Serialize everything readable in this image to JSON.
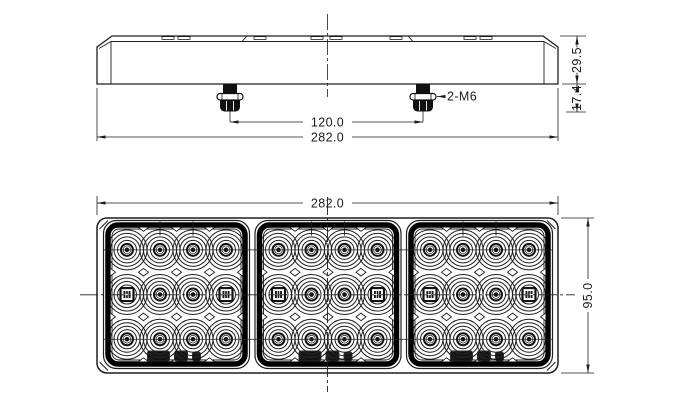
{
  "drawing": {
    "type": "technical-drawing",
    "subject": "led-combination-tail-lamp",
    "line_color": "#1f1f1f",
    "bezel_color": "#000000",
    "background": "#ffffff"
  },
  "views": {
    "top_view": {
      "dims": {
        "bolt_spacing": "120.0",
        "overall_width": "282.0",
        "body_height": "29.5",
        "stud_length": "17.4"
      },
      "callout_studs": "2-M6",
      "stud_count": 2
    },
    "front_view": {
      "dims": {
        "overall_width": "282.0",
        "overall_height": "95.0"
      },
      "modules": 3,
      "led_cols": 4,
      "led_rows": 3
    }
  }
}
